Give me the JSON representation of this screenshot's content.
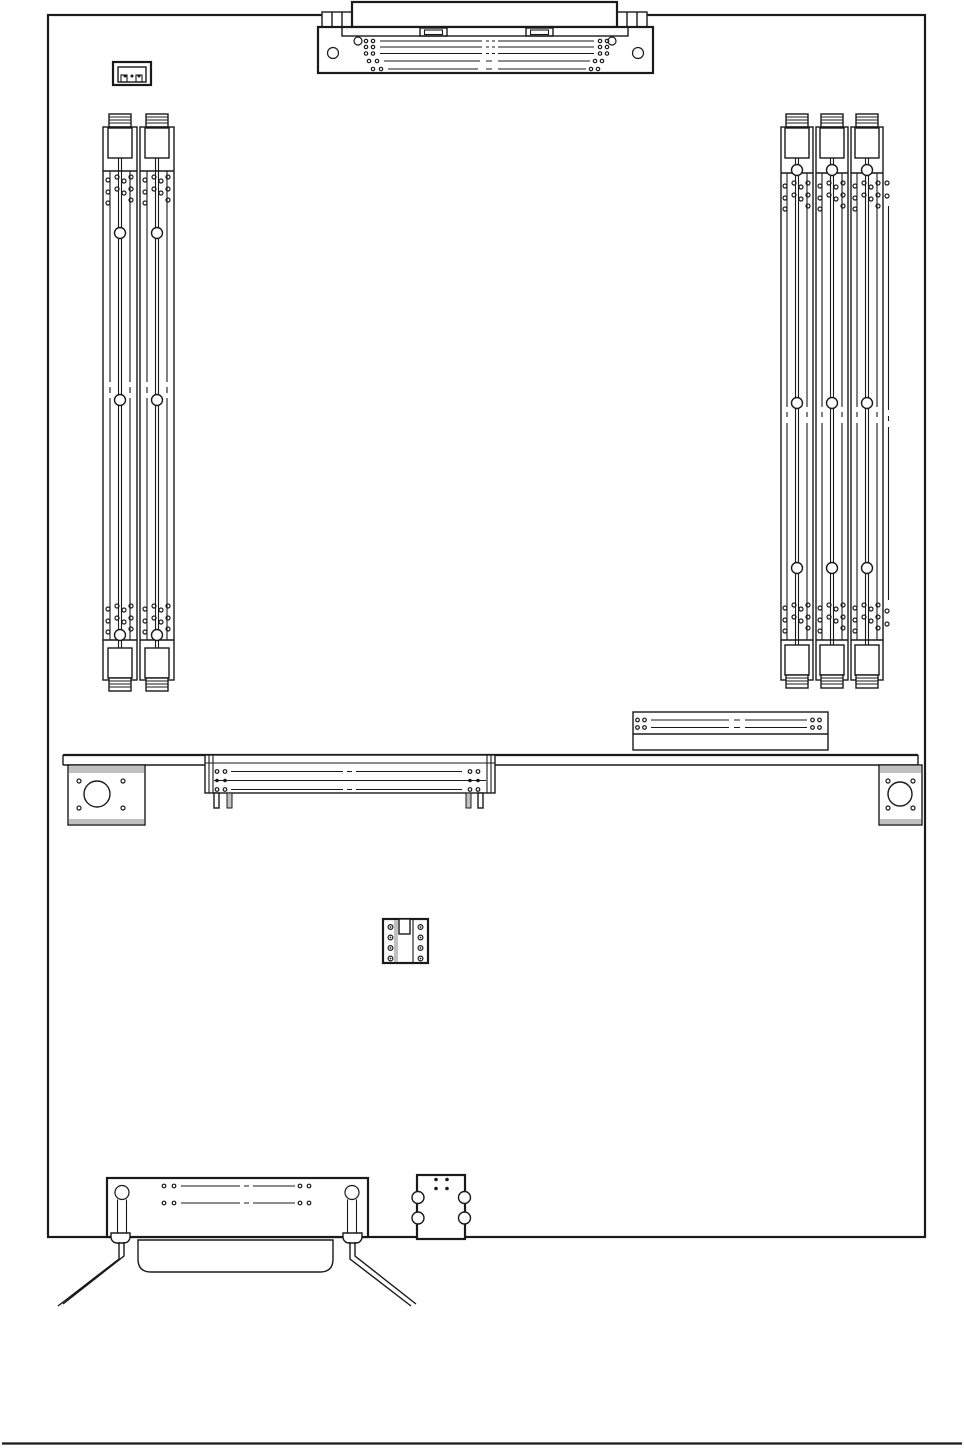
{
  "colors": {
    "bg": "#ffffff",
    "line": "#1a1a1a",
    "shade": "#c0c0c0"
  },
  "diagram": {
    "type": "technical-line-drawing",
    "subject": "system-board-component-layout",
    "text_labels": [],
    "components": {
      "top_edge_connector": {
        "kind": "edge-connector-with-tabs",
        "pin_rows": 5
      },
      "three_pin_header": {
        "kind": "3-pin-header",
        "pins": 3
      },
      "memory_bank_left": {
        "kind": "memory-slots",
        "slot_count": 2
      },
      "memory_bank_right": {
        "kind": "memory-slots",
        "slot_count": 3
      },
      "mid_board_connector": {
        "kind": "horizontal-connector",
        "pin_rows": 2
      },
      "mounting_rail": {
        "kind": "full-width-rail"
      },
      "mounting_brackets": {
        "kind": "bracket-plate-with-hole",
        "count": 2
      },
      "riser_connector": {
        "kind": "horizontal-connector-with-legs",
        "pin_rows": 3
      },
      "dip_socket": {
        "kind": "socket",
        "holes_per_side": 4
      },
      "external_connector": {
        "kind": "d-shell-connector-with-support-legs",
        "screw_posts": 2
      },
      "small_module": {
        "kind": "module",
        "side_holes": 4,
        "top_dots": 4
      }
    }
  }
}
